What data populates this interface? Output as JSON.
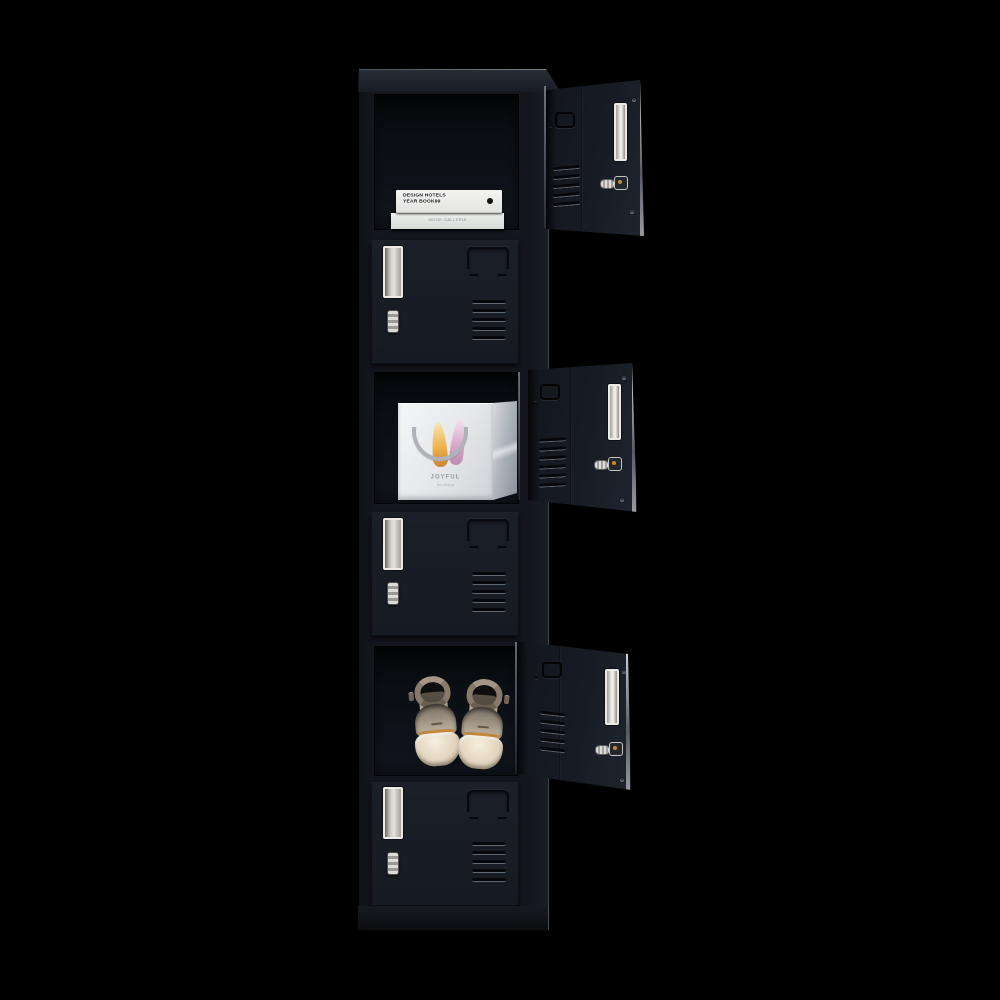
{
  "scene": {
    "type": "product-photo",
    "product_name": "6-Door Black Metal Storage Locker",
    "description": "Tall black six-compartment locker photographed on a black background; three doors open revealing books, a gift bag and a pair of heels",
    "background_color": "#000000"
  },
  "theme": {
    "bg": "#000000",
    "body": "#13161d",
    "door": "#1b2028",
    "interior": "#10131a",
    "hardware-white": "#edebe7",
    "silver": "#c6c6c3",
    "key-gold": "#c98a2e",
    "book-white": "#f4f5f3",
    "bag-light": "#f5f6f7",
    "feather-orange": "#eeb24d",
    "feather-pink": "#d9aacb",
    "shoe-cream": "#e2d5bf",
    "shoe-strap": "#877a6a",
    "shoe-trim": "#bd7a2c"
  },
  "locker": {
    "compartments": [
      {
        "index": 1,
        "state": "open",
        "contents": "books"
      },
      {
        "index": 2,
        "state": "closed",
        "contents": ""
      },
      {
        "index": 3,
        "state": "open",
        "contents": "gift bag"
      },
      {
        "index": 4,
        "state": "closed",
        "contents": ""
      },
      {
        "index": 5,
        "state": "open",
        "contents": "shoes"
      },
      {
        "index": 6,
        "state": "closed",
        "contents": ""
      }
    ],
    "door_hardware": [
      "label holder",
      "cam lock with key",
      "ventilation slots",
      "recessed handle"
    ]
  },
  "contents": {
    "books": {
      "title_line1": "DESIGN HOTELS",
      "title_line2": "YEAR BOOK99",
      "second_spine": "MOOK GALLERIA"
    },
    "gift_bag": {
      "brand": "JOYFUL",
      "sub": "for living"
    },
    "shoes": {
      "style": "cream ankle-strap square-toe heels"
    }
  }
}
